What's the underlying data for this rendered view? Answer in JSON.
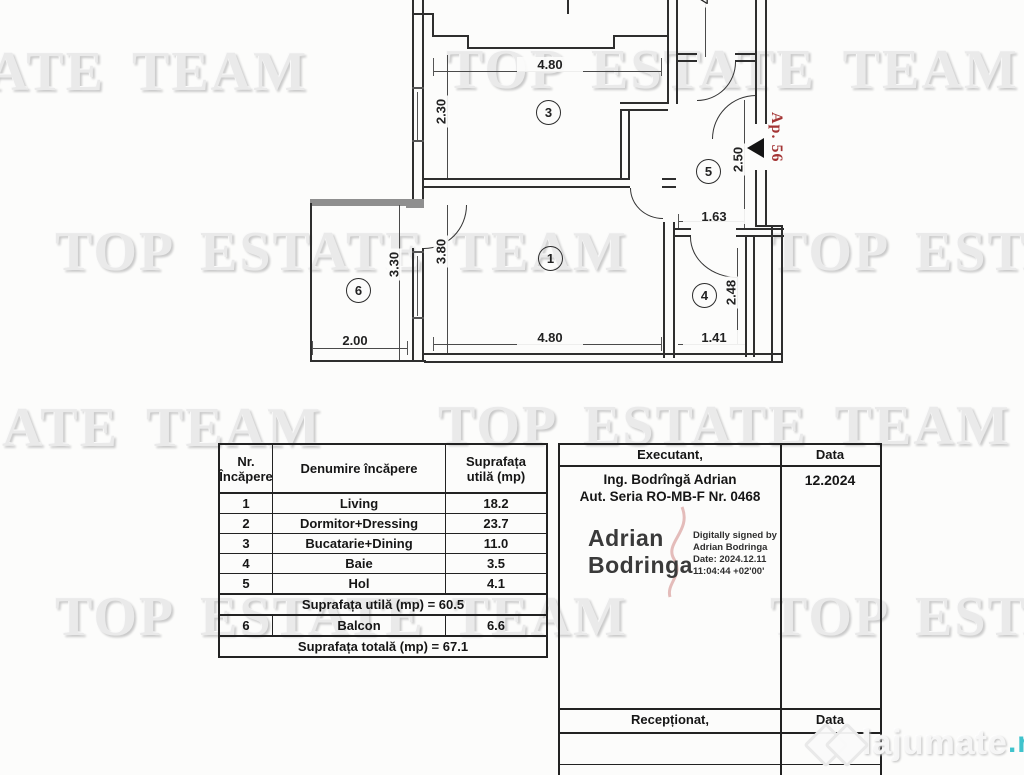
{
  "watermarks": {
    "full": "TOP ESTATE TEAM",
    "tail": "ATE TEAM"
  },
  "floor_plan": {
    "apartment_label": "Ap. 56",
    "rooms": {
      "r1": "1",
      "r3": "3",
      "r4": "4",
      "r5": "5",
      "r6": "6"
    },
    "dimensions": {
      "top_width": "4.80",
      "kitchen_height": "2.30",
      "hall_height": "2.50",
      "hall_width": "1.63",
      "living_width": "4.80",
      "living_height": "3.80",
      "bath_width": "1.41",
      "bath_height": "2.48",
      "balcony_height": "3.30",
      "balcony_width": "2.00",
      "cut_top_dim": "4"
    }
  },
  "rooms_table": {
    "headers": {
      "nr_line1": "Nr.",
      "nr_line2": "Încăpere",
      "name": "Denumire încăpere",
      "area_line1": "Suprafața",
      "area_line2": "utilă (mp)"
    },
    "rows": [
      {
        "nr": "1",
        "name": "Living",
        "area": "18.2"
      },
      {
        "nr": "2",
        "name": "Dormitor+Dressing",
        "area": "23.7"
      },
      {
        "nr": "3",
        "name": "Bucatarie+Dining",
        "area": "11.0"
      },
      {
        "nr": "4",
        "name": "Baie",
        "area": "3.5"
      },
      {
        "nr": "5",
        "name": "Hol",
        "area": "4.1"
      }
    ],
    "subtotal": "Suprafața utilă (mp) = 60.5",
    "balcony_row": {
      "nr": "6",
      "name": "Balcon",
      "area": "6.6"
    },
    "total": "Suprafața totală (mp) = 67.1"
  },
  "signature_block": {
    "executant_label": "Executant,",
    "data_label": "Data",
    "date": "12.2024",
    "engineer_line1": "Ing. Bodrîngă Adrian",
    "engineer_line2": "Aut. Seria RO-MB-F Nr. 0468",
    "signature_name_line1": "Adrian",
    "signature_name_line2": "Bodringa",
    "digital_line1": "Digitally signed by",
    "digital_line2": "Adrian Bodringa",
    "digital_line3": "Date: 2024.12.11",
    "digital_line4": "11:04:44 +02'00'",
    "received_label": "Recepționat,",
    "received_data_label": "Data"
  },
  "branding": {
    "logo_text": "lajumate",
    "logo_tld": ".ro",
    "accent_color": "#3fc3cc"
  }
}
